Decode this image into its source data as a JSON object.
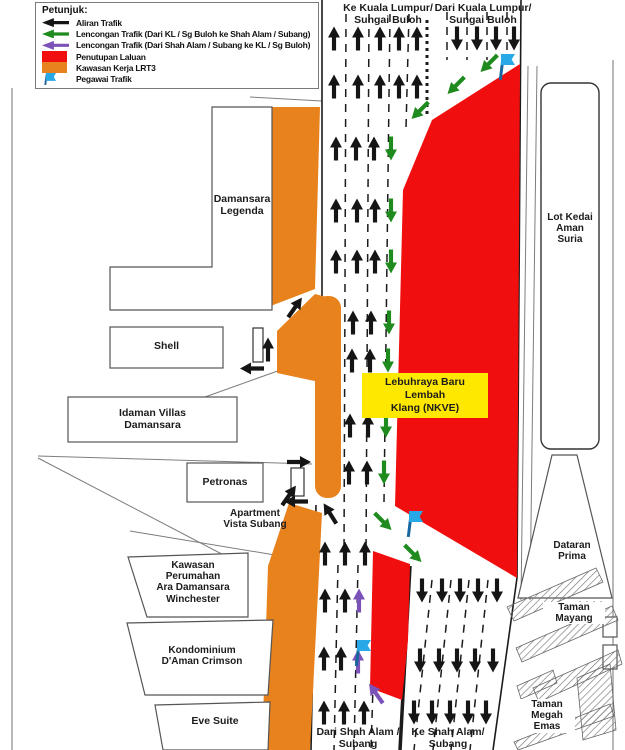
{
  "legend": {
    "title": "Petunjuk:",
    "items": [
      {
        "icon": "black-arrow-icon",
        "label": "Aliran Trafik"
      },
      {
        "icon": "green-arrow-icon",
        "label": "Lencongan Trafik (Dari KL / Sg Buloh ke Shah Alam / Subang)"
      },
      {
        "icon": "purple-arrow-icon",
        "label": "Lencongan Trafik (Dari Shah Alam / Subang ke KL / Sg Buloh)"
      },
      {
        "icon": "red-swatch-icon",
        "label": "Penutupan Laluan"
      },
      {
        "icon": "orange-swatch-icon",
        "label": "Kawasan Kerja LRT3"
      },
      {
        "icon": "blue-flag-icon",
        "label": "Pegawai Trafik"
      }
    ]
  },
  "map": {
    "labels": {
      "ke_kl": "Ke Kuala Lumpur/\nSungai Buloh",
      "dari_kl": "Dari Kuala Lumpur/\nSungai Buloh",
      "dari_sa": "Dari Shah Alam /\nSubang",
      "ke_sa": "Ke Shah Alam/\nSubang",
      "nkve": "Lebuhraya Baru Lembah\nKlang (NKVE)",
      "damansara_legenda": "Damansara\nLegenda",
      "shell": "Shell",
      "idaman_villas": "Idaman Villas\nDamansara",
      "petronas": "Petronas",
      "vista_subang": "Apartment\nVista Subang",
      "winchester": "Kawasan\nPerumahan\nAra Damansara\nWinchester",
      "crimson": "Kondominium\nD'Aman Crimson",
      "eve_suite": "Eve Suite",
      "lot_kedai": "Lot Kedai\nAman\nSuria",
      "dataran_prima": "Dataran\nPrima",
      "taman_mayang": "Taman\nMayang",
      "taman_megah": "Taman\nMegah\nEmas"
    },
    "colors": {
      "traffic_arrow": "#151515",
      "diversion_from_kl": "#1F8B1F",
      "diversion_to_kl": "#7B52B8",
      "road_closure": "#F10E0E",
      "lrt3_work_area": "#E8821C",
      "officer_flag": "#29A8E8",
      "highway_label_bg": "#FFE800"
    },
    "arrows": {
      "black": [
        [
          334,
          38,
          0
        ],
        [
          358,
          38,
          0
        ],
        [
          380,
          38,
          0
        ],
        [
          399,
          38,
          0
        ],
        [
          417,
          38,
          0
        ],
        [
          334,
          86,
          0
        ],
        [
          358,
          86,
          0
        ],
        [
          380,
          86,
          0
        ],
        [
          399,
          86,
          0
        ],
        [
          417,
          86,
          0
        ],
        [
          336,
          148,
          0
        ],
        [
          356,
          148,
          0
        ],
        [
          374,
          148,
          0
        ],
        [
          336,
          210,
          0
        ],
        [
          357,
          210,
          0
        ],
        [
          375,
          210,
          0
        ],
        [
          336,
          261,
          0
        ],
        [
          357,
          261,
          0
        ],
        [
          375,
          261,
          0
        ],
        [
          353,
          322,
          0
        ],
        [
          371,
          322,
          0
        ],
        [
          352,
          360,
          0
        ],
        [
          370,
          360,
          0
        ],
        [
          350,
          425,
          0
        ],
        [
          368,
          425,
          0
        ],
        [
          349,
          472,
          0
        ],
        [
          367,
          472,
          0
        ],
        [
          325,
          553,
          0
        ],
        [
          345,
          553,
          0
        ],
        [
          365,
          553,
          0
        ],
        [
          325,
          600,
          0
        ],
        [
          345,
          600,
          0
        ],
        [
          324,
          658,
          0
        ],
        [
          341,
          658,
          0
        ],
        [
          324,
          712,
          0
        ],
        [
          344,
          712,
          0
        ],
        [
          364,
          712,
          0
        ],
        [
          457,
          38,
          180
        ],
        [
          477,
          38,
          180
        ],
        [
          496,
          38,
          180
        ],
        [
          514,
          38,
          180
        ],
        [
          422,
          590,
          180
        ],
        [
          442,
          590,
          180
        ],
        [
          460,
          590,
          180
        ],
        [
          478,
          590,
          180
        ],
        [
          497,
          590,
          180
        ],
        [
          420,
          660,
          180
        ],
        [
          439,
          660,
          180
        ],
        [
          457,
          660,
          180
        ],
        [
          475,
          660,
          180
        ],
        [
          493,
          660,
          180
        ],
        [
          414,
          712,
          180
        ],
        [
          432,
          712,
          180
        ],
        [
          450,
          712,
          180
        ],
        [
          468,
          712,
          180
        ],
        [
          486,
          712,
          180
        ],
        [
          268,
          349,
          0
        ],
        [
          252,
          368,
          270
        ],
        [
          299,
          462,
          90
        ],
        [
          296,
          501,
          270
        ],
        [
          295,
          307,
          35
        ],
        [
          289,
          495,
          35
        ],
        [
          330,
          513,
          -32
        ]
      ],
      "green": [
        [
          489,
          63,
          225
        ],
        [
          456,
          85,
          225
        ],
        [
          420,
          110,
          225
        ],
        [
          391,
          148,
          180
        ],
        [
          391,
          210,
          180
        ],
        [
          391,
          261,
          180
        ],
        [
          389,
          322,
          180
        ],
        [
          388,
          360,
          180
        ],
        [
          386,
          425,
          180
        ],
        [
          384,
          472,
          180
        ],
        [
          383,
          521,
          135
        ],
        [
          413,
          553,
          135
        ]
      ],
      "purple": [
        [
          359,
          600,
          0
        ],
        [
          358,
          661,
          0
        ],
        [
          376,
          693,
          -35
        ]
      ]
    },
    "flags": [
      [
        496,
        54
      ],
      [
        404,
        511
      ],
      [
        352,
        640
      ]
    ]
  }
}
